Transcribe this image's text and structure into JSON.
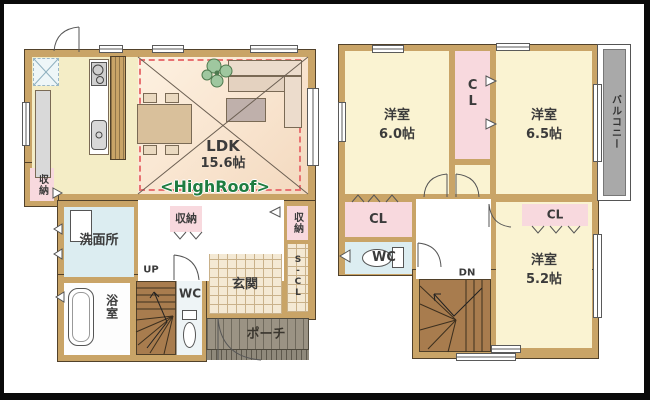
{
  "floor1": {
    "ldk_label": "LDK",
    "ldk_size": "15.6帖",
    "highroof": "<HighRoof>",
    "storage_left": "収納",
    "washroom": "洗面所",
    "bath": "浴室",
    "up": "UP",
    "storage_hall": "収納",
    "wc": "WC",
    "entrance": "玄関",
    "shoe_closet": "S-CL",
    "storage_right": "収納",
    "porch": "ポーチ"
  },
  "floor2": {
    "room_a_label": "洋室",
    "room_a_size": "6.0帖",
    "cl_a": "CL",
    "room_b_label": "洋室",
    "room_b_size": "6.5帖",
    "balcony": "バルコニー",
    "cl_b": "CL",
    "wc": "WC",
    "dn": "DN",
    "room_c_label": "洋室",
    "room_c_size": "5.2帖",
    "cl_c": "CL"
  },
  "colors": {
    "wall": "#c9a467",
    "kitchen": "#f4edc6",
    "cream": "#faf3d2",
    "pink": "#f8d9de",
    "blue": "#dcedf1",
    "stairs": "#a87c4e",
    "porch": "#9b9384",
    "balcony": "#a9a9a9",
    "highroof_green": "#1e7c40",
    "dashed_red": "#e87272"
  }
}
